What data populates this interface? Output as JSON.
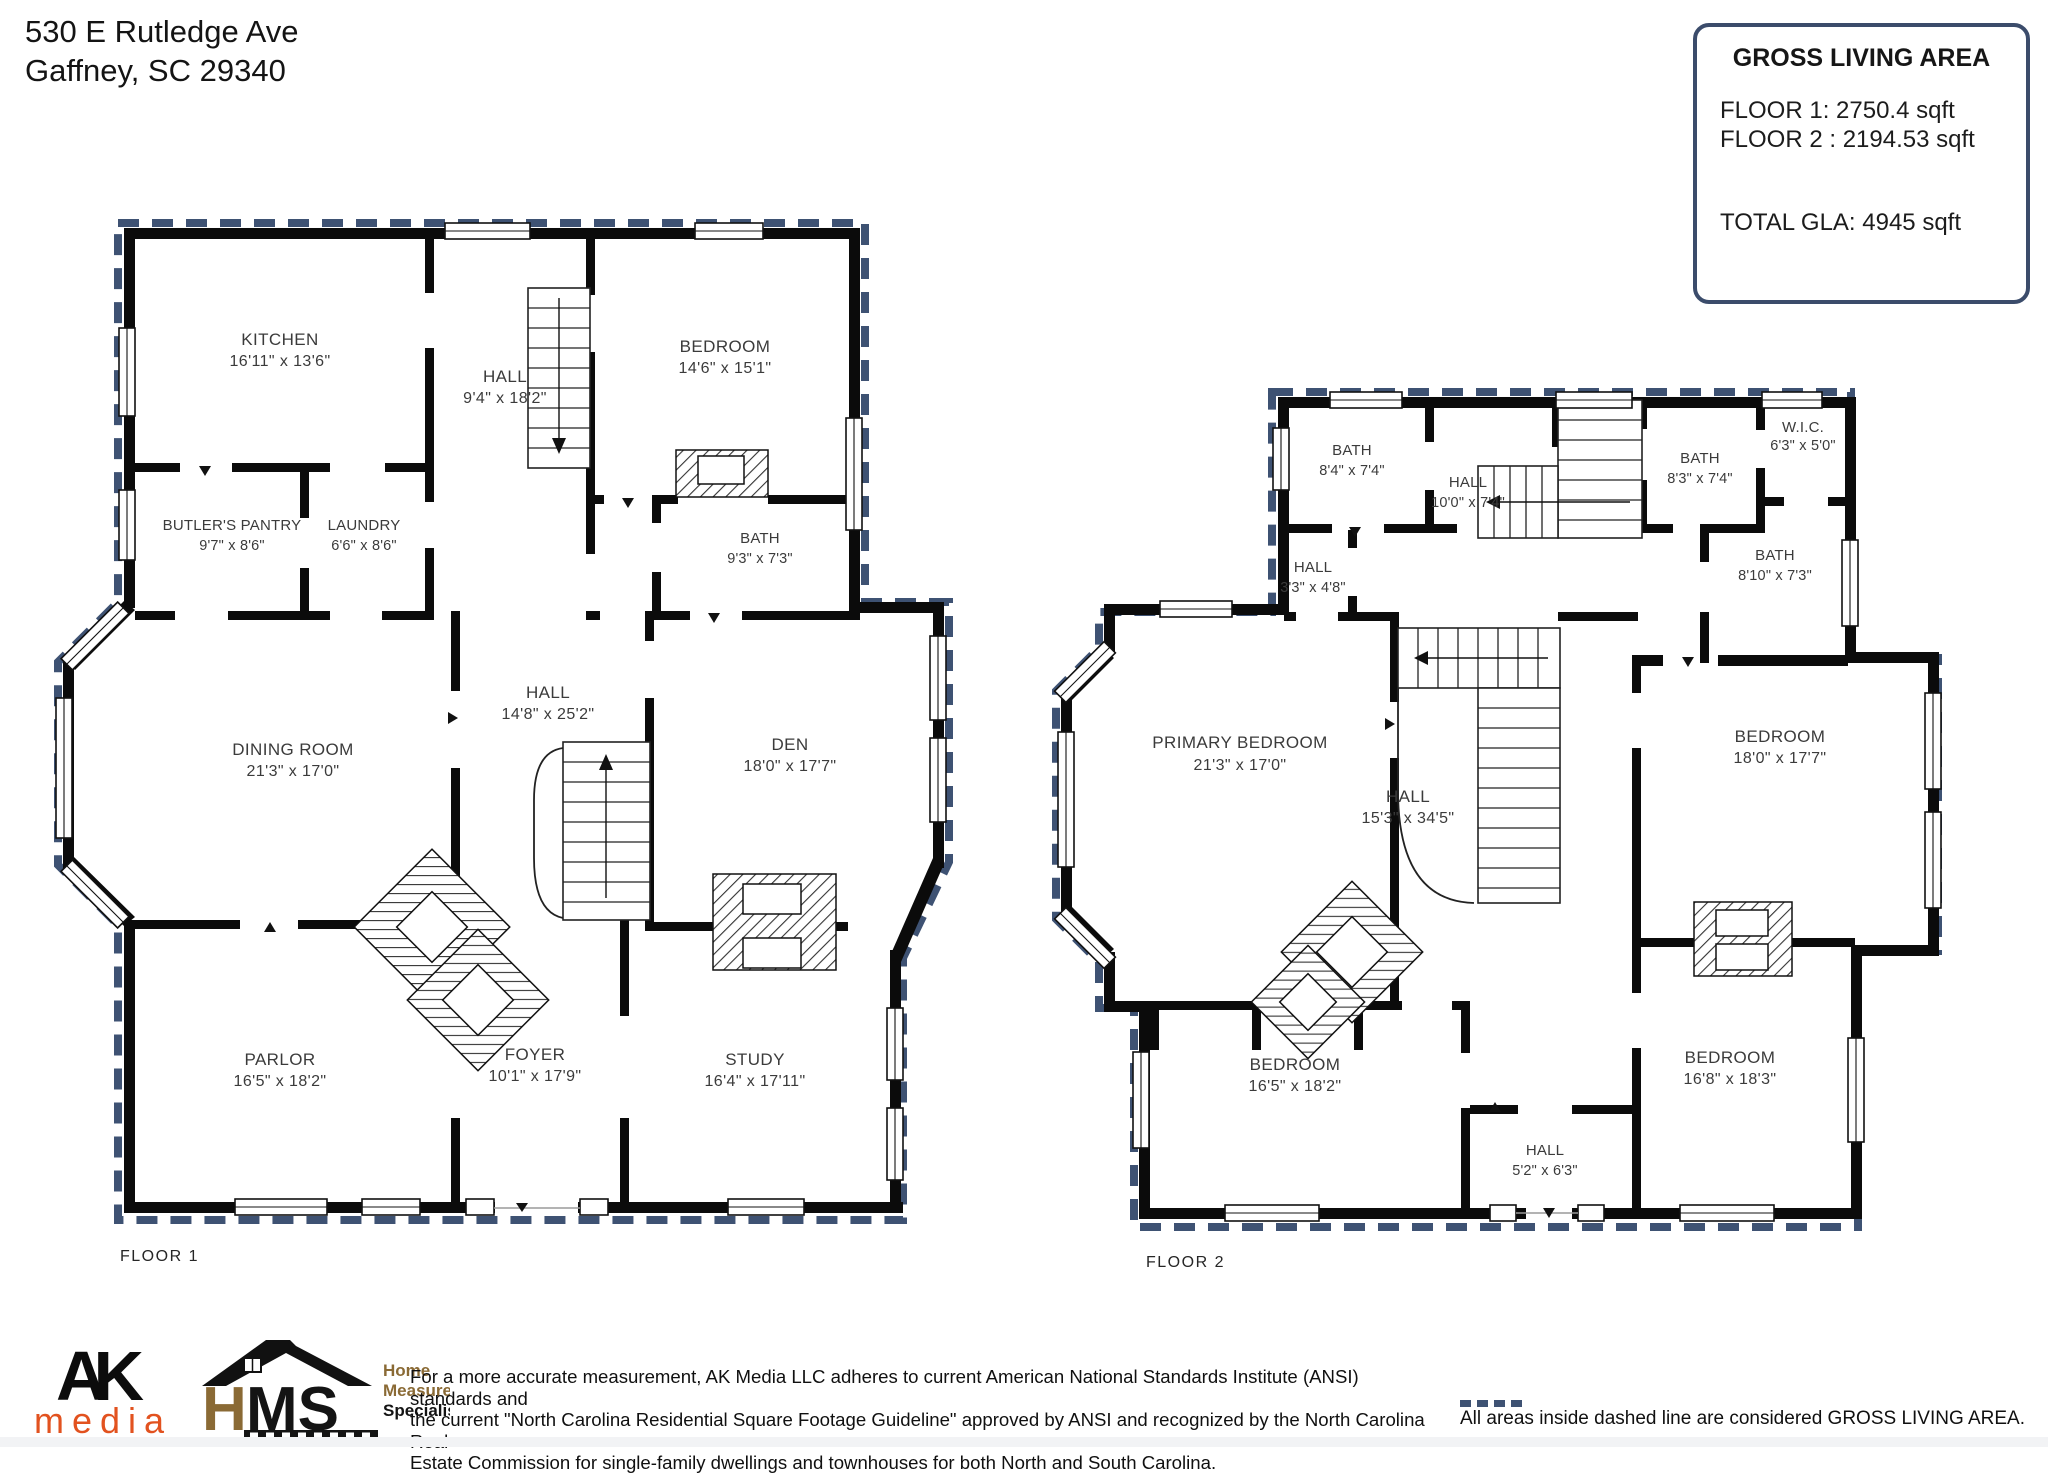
{
  "address": {
    "line1": "530 E Rutledge Ave",
    "line2": "Gaffney, SC  29340"
  },
  "gla": {
    "title": "GROSS LIVING AREA",
    "floor1": "FLOOR 1: 2750.4 sqft",
    "floor2": "FLOOR 2 : 2194.53 sqft",
    "total": "TOTAL GLA: 4945 sqft"
  },
  "floors": [
    {
      "label": "FLOOR 1",
      "rooms": [
        {
          "name": "KITCHEN",
          "dims": "16'11\" x 13'6\""
        },
        {
          "name": "HALL",
          "dims": "9'4\" x 18'2\""
        },
        {
          "name": "BEDROOM",
          "dims": "14'6\" x 15'1\""
        },
        {
          "name": "BUTLER'S PANTRY",
          "dims": "9'7\" x 8'6\""
        },
        {
          "name": "LAUNDRY",
          "dims": "6'6\" x 8'6\""
        },
        {
          "name": "BATH",
          "dims": "9'3\" x 7'3\""
        },
        {
          "name": "DINING ROOM",
          "dims": "21'3\" x 17'0\""
        },
        {
          "name": "HALL",
          "dims": "14'8\" x 25'2\""
        },
        {
          "name": "DEN",
          "dims": "18'0\" x 17'7\""
        },
        {
          "name": "PARLOR",
          "dims": "16'5\" x 18'2\""
        },
        {
          "name": "FOYER",
          "dims": "10'1\" x 17'9\""
        },
        {
          "name": "STUDY",
          "dims": "16'4\" x 17'11\""
        }
      ]
    },
    {
      "label": "FLOOR 2",
      "rooms": [
        {
          "name": "BATH",
          "dims": "8'4\" x 7'4\""
        },
        {
          "name": "HALL",
          "dims": "10'0\" x 7'4\""
        },
        {
          "name": "BATH",
          "dims": "8'3\" x 7'4\""
        },
        {
          "name": "W.I.C.",
          "dims": "6'3\" x 5'0\""
        },
        {
          "name": "BATH",
          "dims": "8'10\" x 7'3\""
        },
        {
          "name": "HALL",
          "dims": "3'3\" x 4'8\""
        },
        {
          "name": "PRIMARY BEDROOM",
          "dims": "21'3\" x 17'0\""
        },
        {
          "name": "HALL",
          "dims": "15'3\" x 34'5\""
        },
        {
          "name": "BEDROOM",
          "dims": "18'0\" x 17'7\""
        },
        {
          "name": "BEDROOM",
          "dims": "16'5\" x 18'2\""
        },
        {
          "name": "HALL",
          "dims": "5'2\" x 6'3\""
        },
        {
          "name": "BEDROOM",
          "dims": "16'8\" x 18'3\""
        }
      ]
    }
  ],
  "footer": {
    "ak": {
      "word_top": "AK",
      "word_bottom": "media"
    },
    "hms": {
      "h": "H",
      "ms": "MS",
      "tag1": "Home",
      "tag2": "Measurement",
      "tag3": "Specialists®"
    },
    "disclaimer": {
      "line1": "For a more accurate measurement, AK Media LLC adheres to current American National Standards Institute (ANSI) standards and",
      "line2": "the current \"North Carolina Residential Square Footage Guideline\" approved by ANSI and recognized by the North Carolina Real",
      "line3": "Estate Commission for single-family dwellings and townhouses for both North and South Carolina."
    },
    "legend": "All areas inside dashed line are considered GROSS LIVING AREA."
  },
  "colors": {
    "boundary": "#3e5273",
    "wall": "#0b0b0b",
    "ak_orange": "#e2521f",
    "hms_gold": "#8a6a35"
  }
}
